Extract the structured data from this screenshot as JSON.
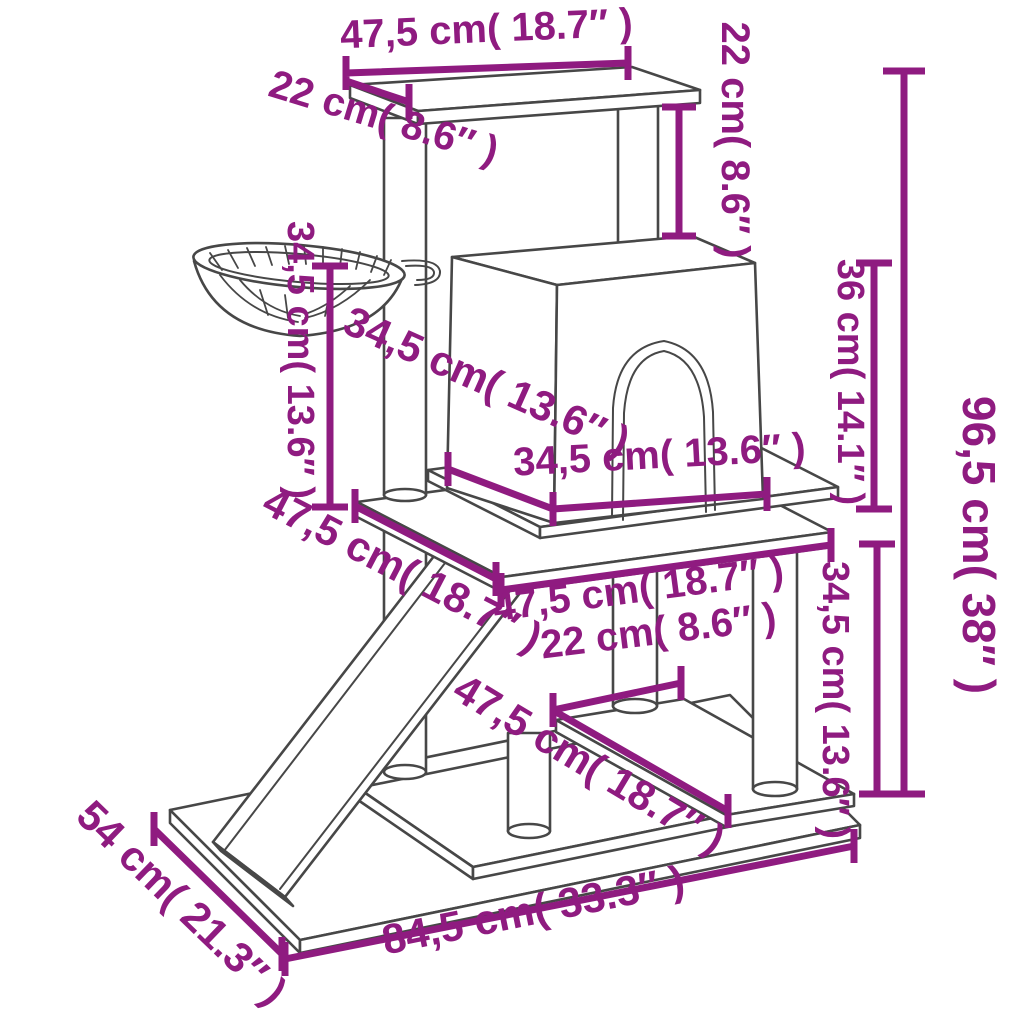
{
  "diagram": {
    "subject": "cat tree with scratching posts - dimension diagram",
    "accent_color": "#8f1b80",
    "line_color": "#474747",
    "background_color": "#ffffff",
    "unit_primary": "cm",
    "unit_secondary": "inch"
  },
  "labels": {
    "top_width": "47,5 cm( 18.7″ )",
    "top_depth": "22 cm( 8.6″ )",
    "top_to_house": "22 cm( 8.6″ )",
    "basket_to_platform": "34,5 cm( 13.6″ )",
    "house_depth": "34,5 cm( 13.6″ )",
    "house_height": "36 cm( 14.1″ )",
    "total_height": "96,5 cm( 38″ )",
    "house_width": "34,5 cm( 13.6″ )",
    "mid_depth": "47,5 cm( 18.7″ )",
    "mid_width": "47,5 cm( 18.7″ )",
    "shelf_depth": "22 cm( 8.6″ )",
    "shelf_length": "47,5 cm( 18.7″ )",
    "platform_to_shelf": "34,5 cm( 13.6″ )",
    "base_depth": "54 cm( 21.3″ )",
    "base_width": "84,5 cm( 33.3″ )"
  },
  "measurements": [
    {
      "id": "top_width",
      "cm": "47,5",
      "inch": "18.7"
    },
    {
      "id": "top_depth",
      "cm": "22",
      "inch": "8.6"
    },
    {
      "id": "top_to_house",
      "cm": "22",
      "inch": "8.6"
    },
    {
      "id": "basket_to_platform",
      "cm": "34,5",
      "inch": "13.6"
    },
    {
      "id": "house_depth",
      "cm": "34,5",
      "inch": "13.6"
    },
    {
      "id": "house_height",
      "cm": "36",
      "inch": "14.1"
    },
    {
      "id": "total_height",
      "cm": "96,5",
      "inch": "38"
    },
    {
      "id": "house_width",
      "cm": "34,5",
      "inch": "13.6"
    },
    {
      "id": "mid_depth",
      "cm": "47,5",
      "inch": "18.7"
    },
    {
      "id": "mid_width",
      "cm": "47,5",
      "inch": "18.7"
    },
    {
      "id": "shelf_depth",
      "cm": "22",
      "inch": "8.6"
    },
    {
      "id": "shelf_length",
      "cm": "47,5",
      "inch": "18.7"
    },
    {
      "id": "platform_to_shelf",
      "cm": "34,5",
      "inch": "13.6"
    },
    {
      "id": "base_depth",
      "cm": "54",
      "inch": "21.3"
    },
    {
      "id": "base_width",
      "cm": "84,5",
      "inch": "33.3"
    }
  ]
}
